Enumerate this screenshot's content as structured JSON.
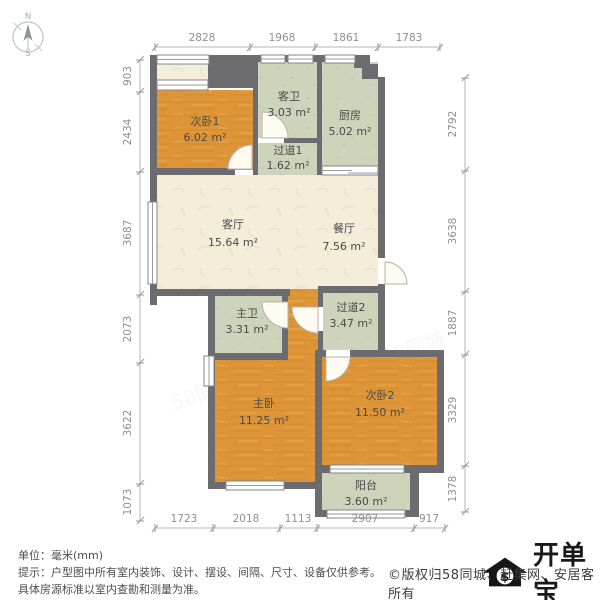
{
  "compass": {
    "north": "N",
    "south": "S"
  },
  "rooms": {
    "bedroom1": {
      "name": "次卧1",
      "area": "6.02 m²"
    },
    "guest_bath": {
      "name": "客卫",
      "area": "3.03 m²"
    },
    "kitchen": {
      "name": "厨房",
      "area": "5.02 m²"
    },
    "hallway1": {
      "name": "过道1",
      "area": "1.62 m²"
    },
    "living": {
      "name": "客厅",
      "area": "15.64 m²"
    },
    "dining": {
      "name": "餐厅",
      "area": "7.56 m²"
    },
    "master_bath": {
      "name": "主卫",
      "area": "3.31 m²"
    },
    "hallway2": {
      "name": "过道2",
      "area": "3.47 m²"
    },
    "master_bedroom": {
      "name": "主卧",
      "area": "11.25 m²"
    },
    "bedroom2": {
      "name": "次卧2",
      "area": "11.50 m²"
    },
    "balcony": {
      "name": "阳台",
      "area": "3.60 m²"
    }
  },
  "dims": {
    "top": [
      "2828",
      "1968",
      "1861",
      "1783"
    ],
    "bottom": [
      "1723",
      "2018",
      "1113",
      "2907",
      "917"
    ],
    "left": [
      "903",
      "2434",
      "3687",
      "2073",
      "3622",
      "1073"
    ],
    "right": [
      "2792",
      "3638",
      "1887",
      "3329",
      "1378"
    ]
  },
  "footer": {
    "unit": "单位：毫米(mm)",
    "tip": "提示：户型图中所有室内装饰、设计、摆设、间隔、尺寸、设备仅供参考。",
    "tip2": "具体房源标准以室内查勘和测量为准。"
  },
  "brand": {
    "logo": "开单宝",
    "currency": "$",
    "copyright": "©版权归58同城、赶集网、安居客所有"
  },
  "watermark": "58同城",
  "colors": {
    "wall": "#6b6b70",
    "wood": "#dd9537",
    "sage": "#ced4bc",
    "cream": "#f3edd9"
  }
}
